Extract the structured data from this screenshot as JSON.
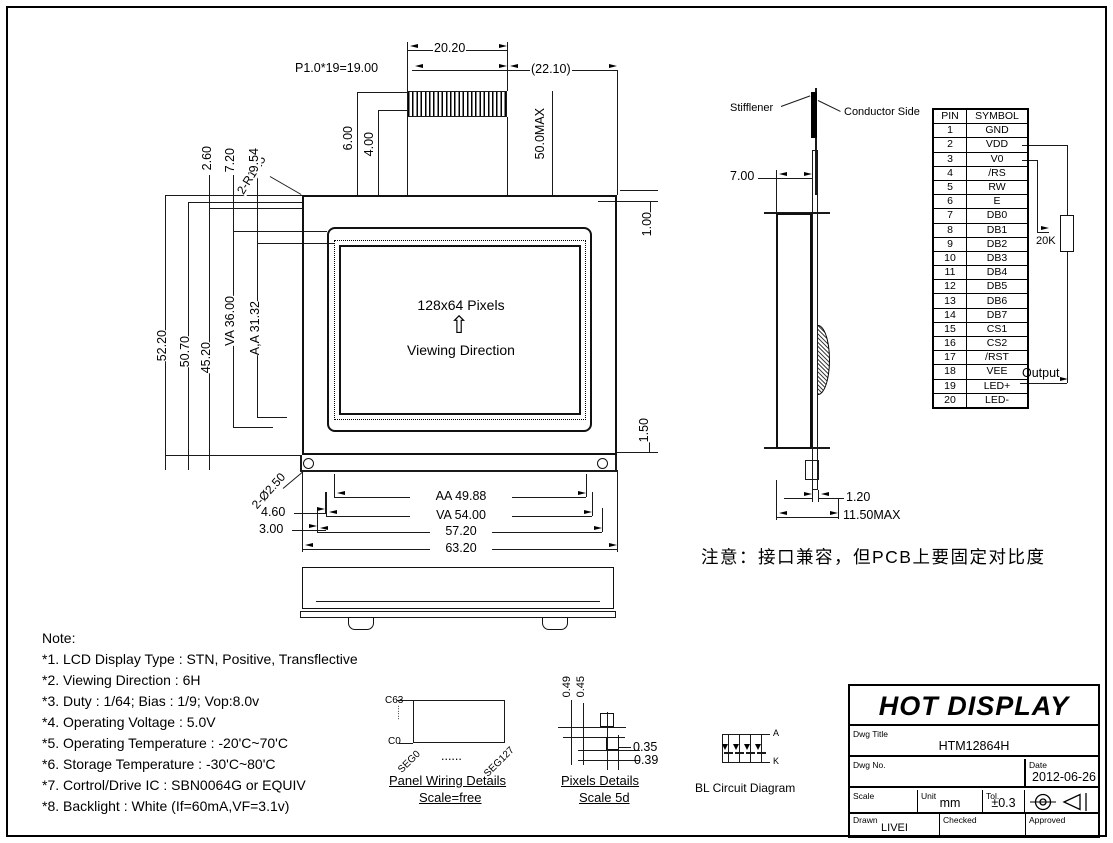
{
  "front_view": {
    "dim_top_width": "20.20",
    "dim_pitch": "P1.0*19=19.00",
    "dim_conn_right": "(22.10)",
    "dim_height_max": "50.0MAX",
    "dim_600": "6.00",
    "dim_400": "4.00",
    "dim_corner": "2-R1.25",
    "dim_100": "1.00",
    "dim_h_5220": "52.20",
    "dim_h_5070": "50.70",
    "dim_h_4520": "45.20",
    "dim_h_va": "VA 36.00",
    "dim_h_aa": "A,A 31.32",
    "dim_260": "2.60",
    "dim_720": "7.20",
    "dim_954": "9.54",
    "display_text": "128x64 Pixels",
    "arrow_glyph": "⇧",
    "viewing_text": "Viewing Direction",
    "dim_150": "1.50",
    "dim_holes": "2-Ø2.50",
    "dim_460": "4.60",
    "dim_300": "3.00",
    "dim_w_aa": "AA 49.88",
    "dim_w_va": "VA 54.00",
    "dim_w_5720": "57.20",
    "dim_w_6320": "63.20"
  },
  "side_view": {
    "stiffener_label": "Stifflener",
    "conductor_label": "Conductor Side",
    "dim_700": "7.00",
    "dim_120": "1.20",
    "dim_depth": "11.50MAX"
  },
  "pin_table": {
    "headers": [
      "PIN",
      "SYMBOL"
    ],
    "rows": [
      [
        "1",
        "GND"
      ],
      [
        "2",
        "VDD"
      ],
      [
        "3",
        "V0"
      ],
      [
        "4",
        "/RS"
      ],
      [
        "5",
        "RW"
      ],
      [
        "6",
        "E"
      ],
      [
        "7",
        "DB0"
      ],
      [
        "8",
        "DB1"
      ],
      [
        "9",
        "DB2"
      ],
      [
        "10",
        "DB3"
      ],
      [
        "11",
        "DB4"
      ],
      [
        "12",
        "DB5"
      ],
      [
        "13",
        "DB6"
      ],
      [
        "14",
        "DB7"
      ],
      [
        "15",
        "CS1"
      ],
      [
        "16",
        "CS2"
      ],
      [
        "17",
        "/RST"
      ],
      [
        "18",
        "VEE"
      ],
      [
        "19",
        "LED+"
      ],
      [
        "20",
        "LED-"
      ]
    ],
    "resistor_label": "20K",
    "output_label": "Output"
  },
  "cn_note": "注意：接口兼容，但PCB上要固定对比度",
  "notes": {
    "title": "Note:",
    "items": [
      "*1. LCD Display Type : STN, Positive, Transflective",
      "*2. Viewing Direction : 6H",
      "*3. Duty : 1/64; Bias : 1/9; Vop:8.0v",
      "*4. Operating Voltage : 5.0V",
      "*5. Operating Temperature : -20'C~70'C",
      "*6. Storage Temperature : -30'C~80'C",
      "*7. Cortrol/Drive IC : SBN0064G or EQUIV",
      "*8. Backlight : White (If=60mA,VF=3.1v)"
    ]
  },
  "panel_wiring": {
    "top_label": "C63",
    "bottom_label": "C0",
    "v_dots": "......",
    "seg_left": "SEG0",
    "h_dots": "......",
    "seg_right": "SEG127",
    "caption": "Panel Wiring Details",
    "scale": "Scale=free"
  },
  "pixels_detail": {
    "dim_049": "0.49",
    "dim_045": "0.45",
    "dim_035": "0.35",
    "dim_039": "0.39",
    "caption": "Pixels Details",
    "scale": "Scale 5d"
  },
  "bl_circuit": {
    "anode": "A",
    "cathode": "K",
    "caption": "BL Circuit Diagram"
  },
  "title_block": {
    "company": "HOT DISPLAY",
    "dwg_title_label": "Dwg Title",
    "dwg_title": "HTM12864H",
    "dwg_no_label": "Dwg No.",
    "date_label": "Date",
    "date": "2012-06-26",
    "scale_label": "Scale",
    "unit_label": "Unit",
    "unit_value": "mm",
    "tol_label": "Tol.",
    "tol_value": "±0.3",
    "drawn_label": "Drawn",
    "drawn_value": "LIVEI",
    "checked_label": "Checked",
    "approved_label": "Approved"
  }
}
